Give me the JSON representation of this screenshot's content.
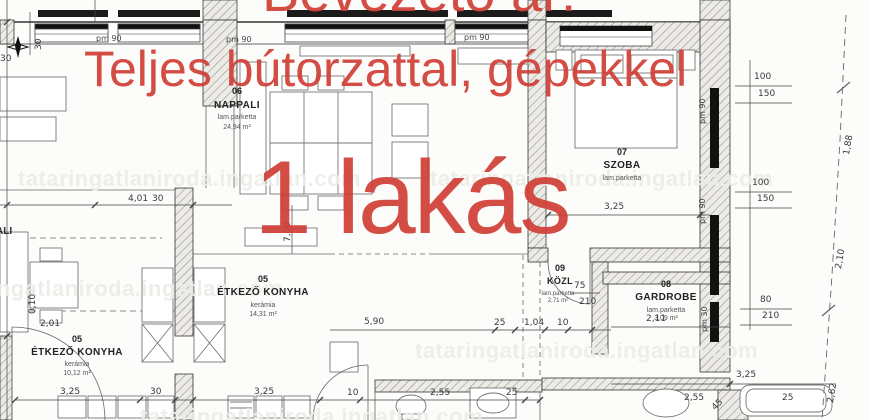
{
  "overlay": {
    "top_line": "Bevezető ár!",
    "middle_line": "Teljes bútorzattal, gépekkel",
    "big_line": "1 lakás",
    "color": "#d04038"
  },
  "watermark": {
    "text": "tataringatlaniroda.ingatlan.com"
  },
  "rooms": {
    "nappali": {
      "number": "06",
      "name": "NAPPALI",
      "floor": "lam.parketta",
      "area": "24,94 m²"
    },
    "szoba": {
      "number": "07",
      "name": "SZOBA",
      "floor": "lam.parketta"
    },
    "etkezo_center": {
      "number": "05",
      "name": "ÉTKEZŐ KONYHA",
      "floor": "kerámia",
      "area": "14,31 m²"
    },
    "etkezo_left": {
      "number": "05",
      "name": "ÉTKEZŐ KONYHA",
      "floor": "kerámia",
      "area": "10,12 m²"
    },
    "kozl": {
      "number": "09",
      "name": "KÖZL",
      "floor": "lam.parketta",
      "area": "2,71 m²"
    },
    "gardrobe": {
      "number": "08",
      "name": "GARDROBE",
      "floor": "lam.parketta",
      "area": "3,09 m²"
    },
    "neighbor_partial": {
      "name": "ALI"
    }
  },
  "dims": [
    "4,01",
    "30",
    "7,00",
    "3,25",
    "100",
    "150",
    "100",
    "150",
    "pm 90",
    "pm 90",
    "pm 90",
    "pm 90",
    "pm 90",
    "pm 30",
    "80",
    "210",
    "1,88",
    "2,10",
    "2,62",
    "75",
    "210",
    "5,90",
    "25",
    "1,04",
    "10",
    "2,11",
    "3,25",
    "30",
    "3,25",
    "10",
    "2,55",
    "25",
    "3,25",
    "2,55",
    "25",
    "30",
    "30",
    "0,10",
    "2,01",
    "45"
  ]
}
